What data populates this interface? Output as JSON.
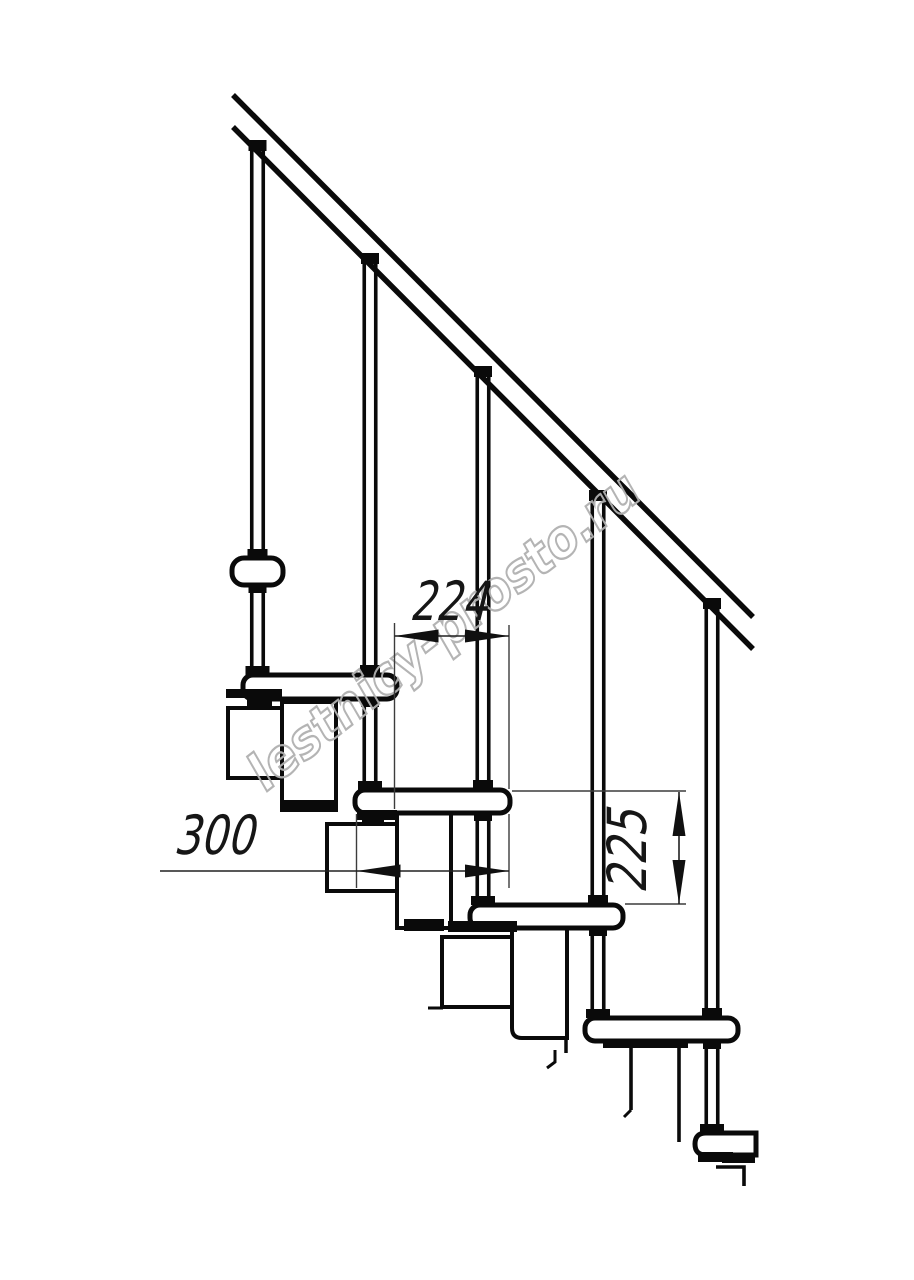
{
  "labels": {
    "going": "224",
    "depth": "300",
    "riser": "225"
  },
  "watermark": {
    "text": "lestnicy-prosto.ru",
    "color": "#b0b0b0"
  },
  "style": {
    "ink": "#0a0a0a",
    "dim_ink": "#3c3c3c",
    "background": "#ffffff"
  },
  "drawing": {
    "shapes": [
      [
        "line",
        233,
        95,
        753,
        617,
        5.5
      ],
      [
        "line",
        233,
        127,
        753,
        649,
        5.5
      ],
      [
        "rect",
        228,
        708,
        55,
        70,
        4,
        0
      ],
      [
        "rect",
        282,
        702,
        54,
        108,
        4,
        0
      ],
      [
        "fill",
        280,
        800,
        58,
        12
      ],
      [
        "rect",
        327,
        824,
        78,
        67,
        4,
        0
      ],
      [
        "rect",
        397,
        812,
        54,
        116,
        4,
        0
      ],
      [
        "fill",
        404,
        919,
        40,
        12
      ],
      [
        "rect",
        442,
        937,
        76,
        70,
        4,
        0
      ],
      [
        "line",
        428,
        1008,
        443,
        1008,
        3
      ],
      [
        "path",
        "M512,928 H567 V1038 H522 Q512,1038 512,1028 Z",
        4
      ],
      [
        "line",
        566,
        1038,
        566,
        1053,
        3.5
      ],
      [
        "poly",
        "555,1050 555,1062 547,1068",
        3
      ],
      [
        "line",
        631,
        1047,
        631,
        1110,
        3.6
      ],
      [
        "line",
        631,
        1110,
        624,
        1117,
        3
      ],
      [
        "line",
        679,
        1047,
        679,
        1142,
        3.6
      ],
      [
        "poly",
        "716,1167 744,1167 744,1186",
        3.6
      ],
      [
        "line",
        251.75,
        150,
        251.75,
        675,
        3.6
      ],
      [
        "line",
        263.25,
        150,
        263.25,
        675,
        3.6
      ],
      [
        "line",
        364.25,
        263,
        364.25,
        790,
        3.6
      ],
      [
        "line",
        375.75,
        263,
        375.75,
        790,
        3.6
      ],
      [
        "line",
        477.25,
        376,
        477.25,
        905,
        3.6
      ],
      [
        "line",
        488.75,
        376,
        488.75,
        905,
        3.6
      ],
      [
        "line",
        592.25,
        500,
        592.25,
        1018,
        3.6
      ],
      [
        "line",
        603.75,
        500,
        603.75,
        1018,
        3.6
      ],
      [
        "line",
        706.25,
        608,
        706.25,
        1133,
        3.6
      ],
      [
        "line",
        717.75,
        608,
        717.75,
        1133,
        3.6
      ],
      [
        "fill",
        248.5,
        140,
        18,
        11
      ],
      [
        "fill",
        361,
        253,
        18,
        11
      ],
      [
        "fill",
        474,
        366,
        18,
        11
      ],
      [
        "fill",
        589,
        490,
        18,
        11
      ],
      [
        "fill",
        703,
        598,
        18,
        11
      ],
      [
        "fill",
        247.5,
        549,
        20,
        10
      ],
      [
        "rect",
        232,
        558,
        51,
        27,
        5,
        12
      ],
      [
        "fill",
        248.5,
        585,
        18,
        8
      ],
      [
        "rect",
        243,
        675,
        154,
        24,
        5,
        10
      ],
      [
        "rect",
        355,
        790,
        155,
        23,
        5,
        10
      ],
      [
        "rect",
        470,
        905,
        153,
        23,
        5,
        10
      ],
      [
        "rect",
        585,
        1018,
        153,
        23,
        5,
        10
      ],
      [
        "path",
        "M756,1133 H706 Q695,1133 695,1144 Q695,1155 706,1155 H756 Z",
        5
      ],
      [
        "fill",
        245.5,
        666,
        24,
        9
      ],
      [
        "fill",
        358,
        781,
        24,
        9
      ],
      [
        "fill",
        471,
        896,
        24,
        9
      ],
      [
        "fill",
        586,
        1009,
        24,
        9
      ],
      [
        "fill",
        700,
        1124,
        24,
        9
      ],
      [
        "fill",
        360,
        665,
        20,
        10
      ],
      [
        "fill",
        361,
        699,
        18,
        8
      ],
      [
        "fill",
        473,
        780,
        20,
        10
      ],
      [
        "fill",
        474,
        813,
        18,
        8
      ],
      [
        "fill",
        588,
        895,
        20,
        10
      ],
      [
        "fill",
        589,
        928,
        18,
        8
      ],
      [
        "fill",
        702,
        1008,
        20,
        10
      ],
      [
        "fill",
        703,
        1041,
        18,
        8
      ],
      [
        "fill",
        226,
        689,
        56,
        9
      ],
      [
        "fill",
        247,
        696,
        25,
        10
      ],
      [
        "fill",
        357,
        810,
        40,
        10
      ],
      [
        "fill",
        362,
        818,
        22,
        8
      ],
      [
        "fill",
        448,
        921,
        69,
        11
      ],
      [
        "fill",
        603,
        1040,
        85,
        8
      ],
      [
        "fill",
        698,
        1152,
        35,
        10
      ],
      [
        "fill",
        722,
        1157,
        33,
        6
      ]
    ]
  },
  "dims": {
    "ext": [
      [
        394.5,
        623,
        394.5,
        809
      ],
      [
        509,
        625,
        509,
        789
      ],
      [
        509,
        814,
        509,
        888
      ],
      [
        356.5,
        814,
        356.5,
        888
      ],
      [
        512,
        791,
        686,
        791
      ],
      [
        625,
        904,
        686,
        904
      ]
    ],
    "lines": [
      [
        394.5,
        636,
        509,
        636
      ],
      [
        160,
        871,
        509,
        871
      ],
      [
        679,
        792,
        679,
        904
      ]
    ],
    "arrows": [
      [
        394.5,
        636,
        "left"
      ],
      [
        509,
        636,
        "right"
      ],
      [
        356.5,
        871,
        "left"
      ],
      [
        509,
        871,
        "right"
      ],
      [
        679,
        792,
        "up"
      ],
      [
        679,
        904,
        "down"
      ]
    ]
  }
}
